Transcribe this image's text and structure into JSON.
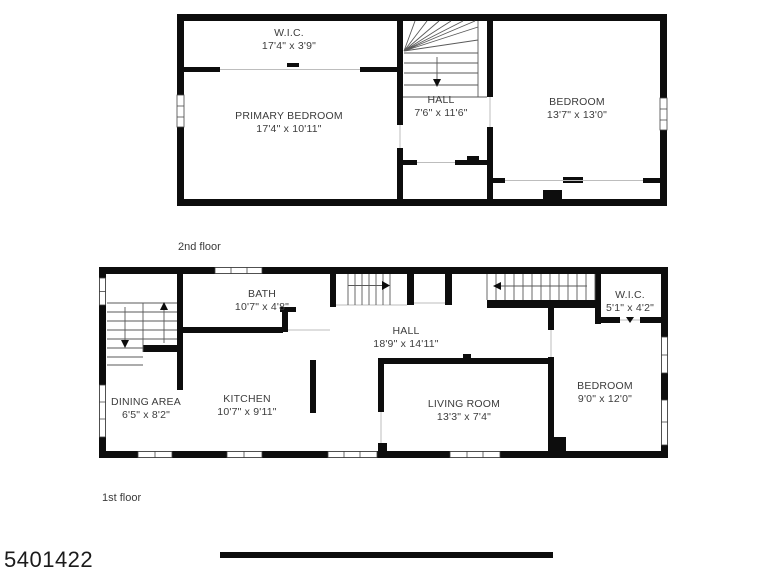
{
  "watermark": "5401422",
  "colors": {
    "wall": "#0d0d0d",
    "text": "#3c3c3c",
    "background": "#ffffff"
  },
  "floors": [
    {
      "name": "2nd floor",
      "rooms": [
        {
          "id": "wic",
          "label": "W.I.C.",
          "dims": "17'4\" x 3'9\""
        },
        {
          "id": "primary-bedroom",
          "label": "PRIMARY BEDROOM",
          "dims": "17'4\" x 10'11\""
        },
        {
          "id": "hall",
          "label": "HALL",
          "dims": "7'6\" x 11'6\""
        },
        {
          "id": "bedroom",
          "label": "BEDROOM",
          "dims": "13'7\" x 13'0\""
        }
      ]
    },
    {
      "name": "1st floor",
      "rooms": [
        {
          "id": "bath",
          "label": "BATH",
          "dims": "10'7\" x 4'8\""
        },
        {
          "id": "wic",
          "label": "W.I.C.",
          "dims": "5'1\" x 4'2\""
        },
        {
          "id": "hall",
          "label": "HALL",
          "dims": "18'9\" x 14'11\""
        },
        {
          "id": "dining-area",
          "label": "DINING AREA",
          "dims": "6'5\" x 8'2\""
        },
        {
          "id": "kitchen",
          "label": "KITCHEN",
          "dims": "10'7\" x 9'11\""
        },
        {
          "id": "living-room",
          "label": "LIVING ROOM",
          "dims": "13'3\" x 7'4\""
        },
        {
          "id": "bedroom",
          "label": "BEDROOM",
          "dims": "9'0\" x 12'0\""
        }
      ]
    }
  ]
}
